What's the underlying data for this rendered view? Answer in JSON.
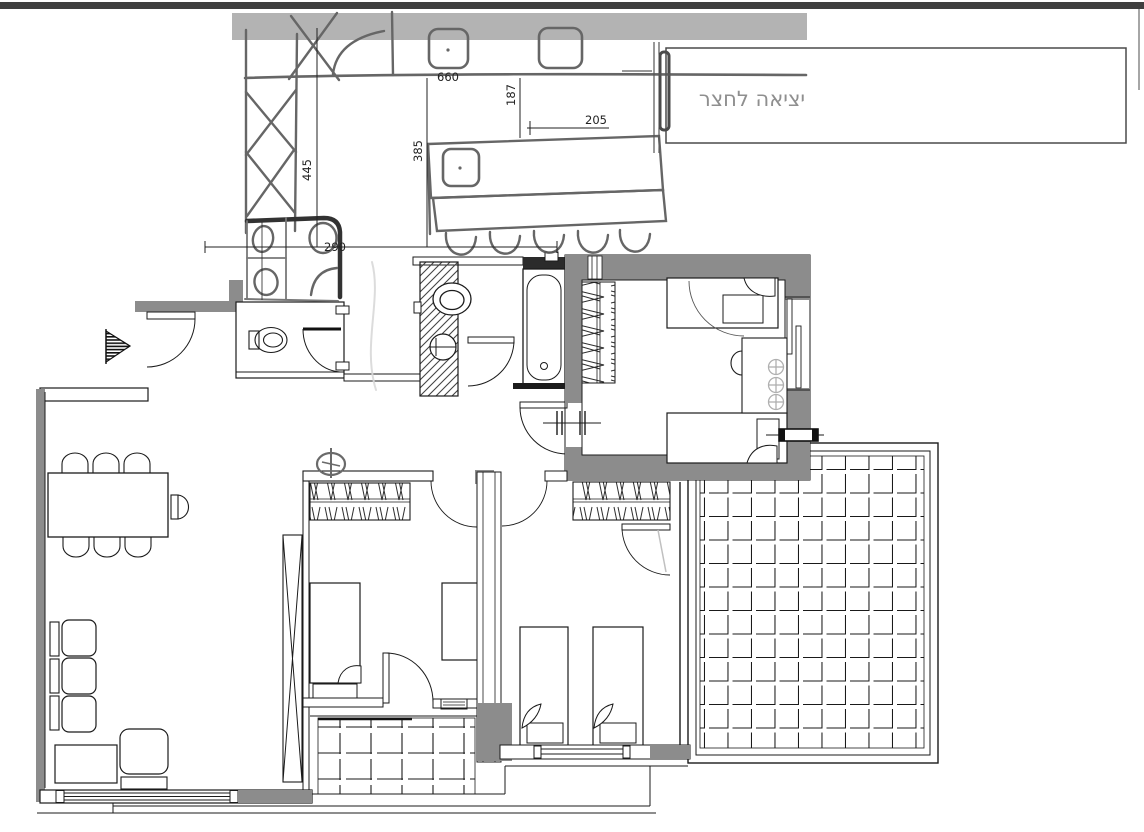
{
  "yard": {
    "label": "יציאה לחצר"
  },
  "dimensions": {
    "counter": "660",
    "counter_depth": "187",
    "island_length": "205",
    "island_width": "385",
    "tall_cabinet": "445",
    "sketch_bath": "290"
  },
  "colors": {
    "wall_fill": "#8c8c8c",
    "sketch_band": "#9c9c9c",
    "cad_line": "#1b1b1b",
    "sketch_stroke": "#565656",
    "sketch_bold": "#1c1c1c",
    "dim_text": "#222222",
    "yard_text": "#8f8f8f",
    "top_bar": "#3f3f3f"
  }
}
